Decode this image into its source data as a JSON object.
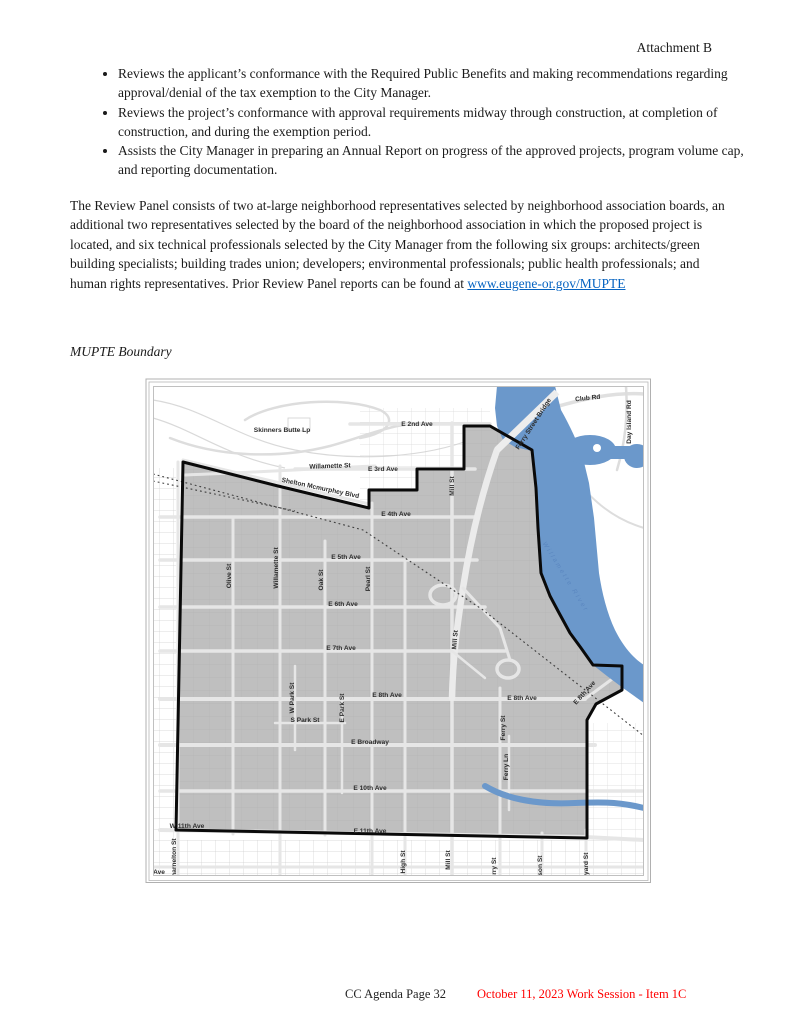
{
  "page": {
    "attachment_label": "Attachment B"
  },
  "bullets": [
    "Reviews the applicant’s conformance with the Required Public Benefits and making recommendations regarding approval/denial of the tax exemption to the City Manager.",
    "Reviews the project’s conformance with approval requirements midway through construction, at completion of construction, and during the exemption period.",
    "Assists the City Manager in preparing an Annual Report on progress of the approved projects, program volume cap, and reporting documentation."
  ],
  "review_panel": {
    "body": "The Review Panel consists of two at-large neighborhood representatives selected by neighborhood association boards, an additional two representatives selected by the board of the neighborhood association in which the proposed project is located, and six technical professionals selected by the City Manager from the following six groups: architects/green building specialists; building trades union; developers; environmental professionals; public health professionals; and human rights representatives. Prior Review Panel reports can be found at ",
    "link_text": "www.eugene-or.gov/MUPTE"
  },
  "map_section": {
    "heading": "MUPTE Boundary"
  },
  "map": {
    "colors": {
      "boundary_fill": "#bfbfbf",
      "boundary_stroke": "#0a0a0a",
      "river_blue": "#6b98cb",
      "road_gray": "#e6e6e6"
    },
    "labels": [
      {
        "t": "Skinners Butte Lp",
        "x": 137,
        "y": 54,
        "r": 0
      },
      {
        "t": "E 2nd Ave",
        "x": 272,
        "y": 48,
        "r": 0
      },
      {
        "t": "Club Rd",
        "x": 443,
        "y": 22,
        "r": -6
      },
      {
        "t": "Ferry Street Bridge",
        "x": 390,
        "y": 47,
        "r": -57
      },
      {
        "t": "Day Island Rd",
        "x": 486,
        "y": 44,
        "r": -90
      },
      {
        "t": "Willamette St",
        "x": 185,
        "y": 90,
        "r": -2
      },
      {
        "t": "E 3rd Ave",
        "x": 238,
        "y": 93,
        "r": 0
      },
      {
        "t": "Shelton Mcmurphey Blvd",
        "x": 175,
        "y": 112,
        "r": 12
      },
      {
        "t": "E 4th Ave",
        "x": 251,
        "y": 138,
        "r": 0
      },
      {
        "t": "Mill St",
        "x": 309,
        "y": 108,
        "r": -90
      },
      {
        "t": "E 5th Ave",
        "x": 201,
        "y": 181,
        "r": 0
      },
      {
        "t": "Olive St",
        "x": 86,
        "y": 198,
        "r": -90
      },
      {
        "t": "Willamette St",
        "x": 133,
        "y": 190,
        "r": -90
      },
      {
        "t": "Oak St",
        "x": 178,
        "y": 202,
        "r": -90
      },
      {
        "t": "Pearl St",
        "x": 225,
        "y": 201,
        "r": -90
      },
      {
        "t": "E 6th Ave",
        "x": 198,
        "y": 228,
        "r": 0
      },
      {
        "t": "Willamette River",
        "x": 419,
        "y": 200,
        "r": 58,
        "cls": "river"
      },
      {
        "t": "E 7th Ave",
        "x": 196,
        "y": 272,
        "r": 0
      },
      {
        "t": "Mill St",
        "x": 312,
        "y": 262,
        "r": -85
      },
      {
        "t": "W Park St",
        "x": 149,
        "y": 320,
        "r": -90
      },
      {
        "t": "E Park St",
        "x": 199,
        "y": 330,
        "r": -90
      },
      {
        "t": "S Park St",
        "x": 160,
        "y": 344,
        "r": 0
      },
      {
        "t": "E 8th Ave",
        "x": 242,
        "y": 319,
        "r": 0
      },
      {
        "t": "E 8th Ave",
        "x": 377,
        "y": 322,
        "r": 0
      },
      {
        "t": "E 8th Ave",
        "x": 441,
        "y": 316,
        "r": -48
      },
      {
        "t": "Ferry St",
        "x": 360,
        "y": 350,
        "r": -90
      },
      {
        "t": "E Broadway",
        "x": 225,
        "y": 366,
        "r": 0
      },
      {
        "t": "Ferry Ln",
        "x": 363,
        "y": 389,
        "r": -90
      },
      {
        "t": "E 10th Ave",
        "x": 225,
        "y": 412,
        "r": 0
      },
      {
        "t": "W 11th Ave",
        "x": 42,
        "y": 450,
        "r": 0
      },
      {
        "t": "E 11th Ave",
        "x": 225,
        "y": 455,
        "r": 0
      },
      {
        "t": "Charnelton St",
        "x": 31,
        "y": 482,
        "r": -90
      },
      {
        "t": "Ave",
        "x": 14,
        "y": 496,
        "r": 0
      },
      {
        "t": "High St",
        "x": 260,
        "y": 484,
        "r": -90
      },
      {
        "t": "Mill St",
        "x": 305,
        "y": 482,
        "r": -90
      },
      {
        "t": "Ferry St",
        "x": 351,
        "y": 492,
        "r": -90
      },
      {
        "t": "Patterson St",
        "x": 397,
        "y": 497,
        "r": -90
      },
      {
        "t": "Hilyard St",
        "x": 443,
        "y": 490,
        "r": -90
      }
    ]
  },
  "footer": {
    "page_label": "CC Agenda Page 32",
    "session_label": "October 11, 2023 Work Session - Item 1C",
    "session_color": "#ff0000"
  }
}
